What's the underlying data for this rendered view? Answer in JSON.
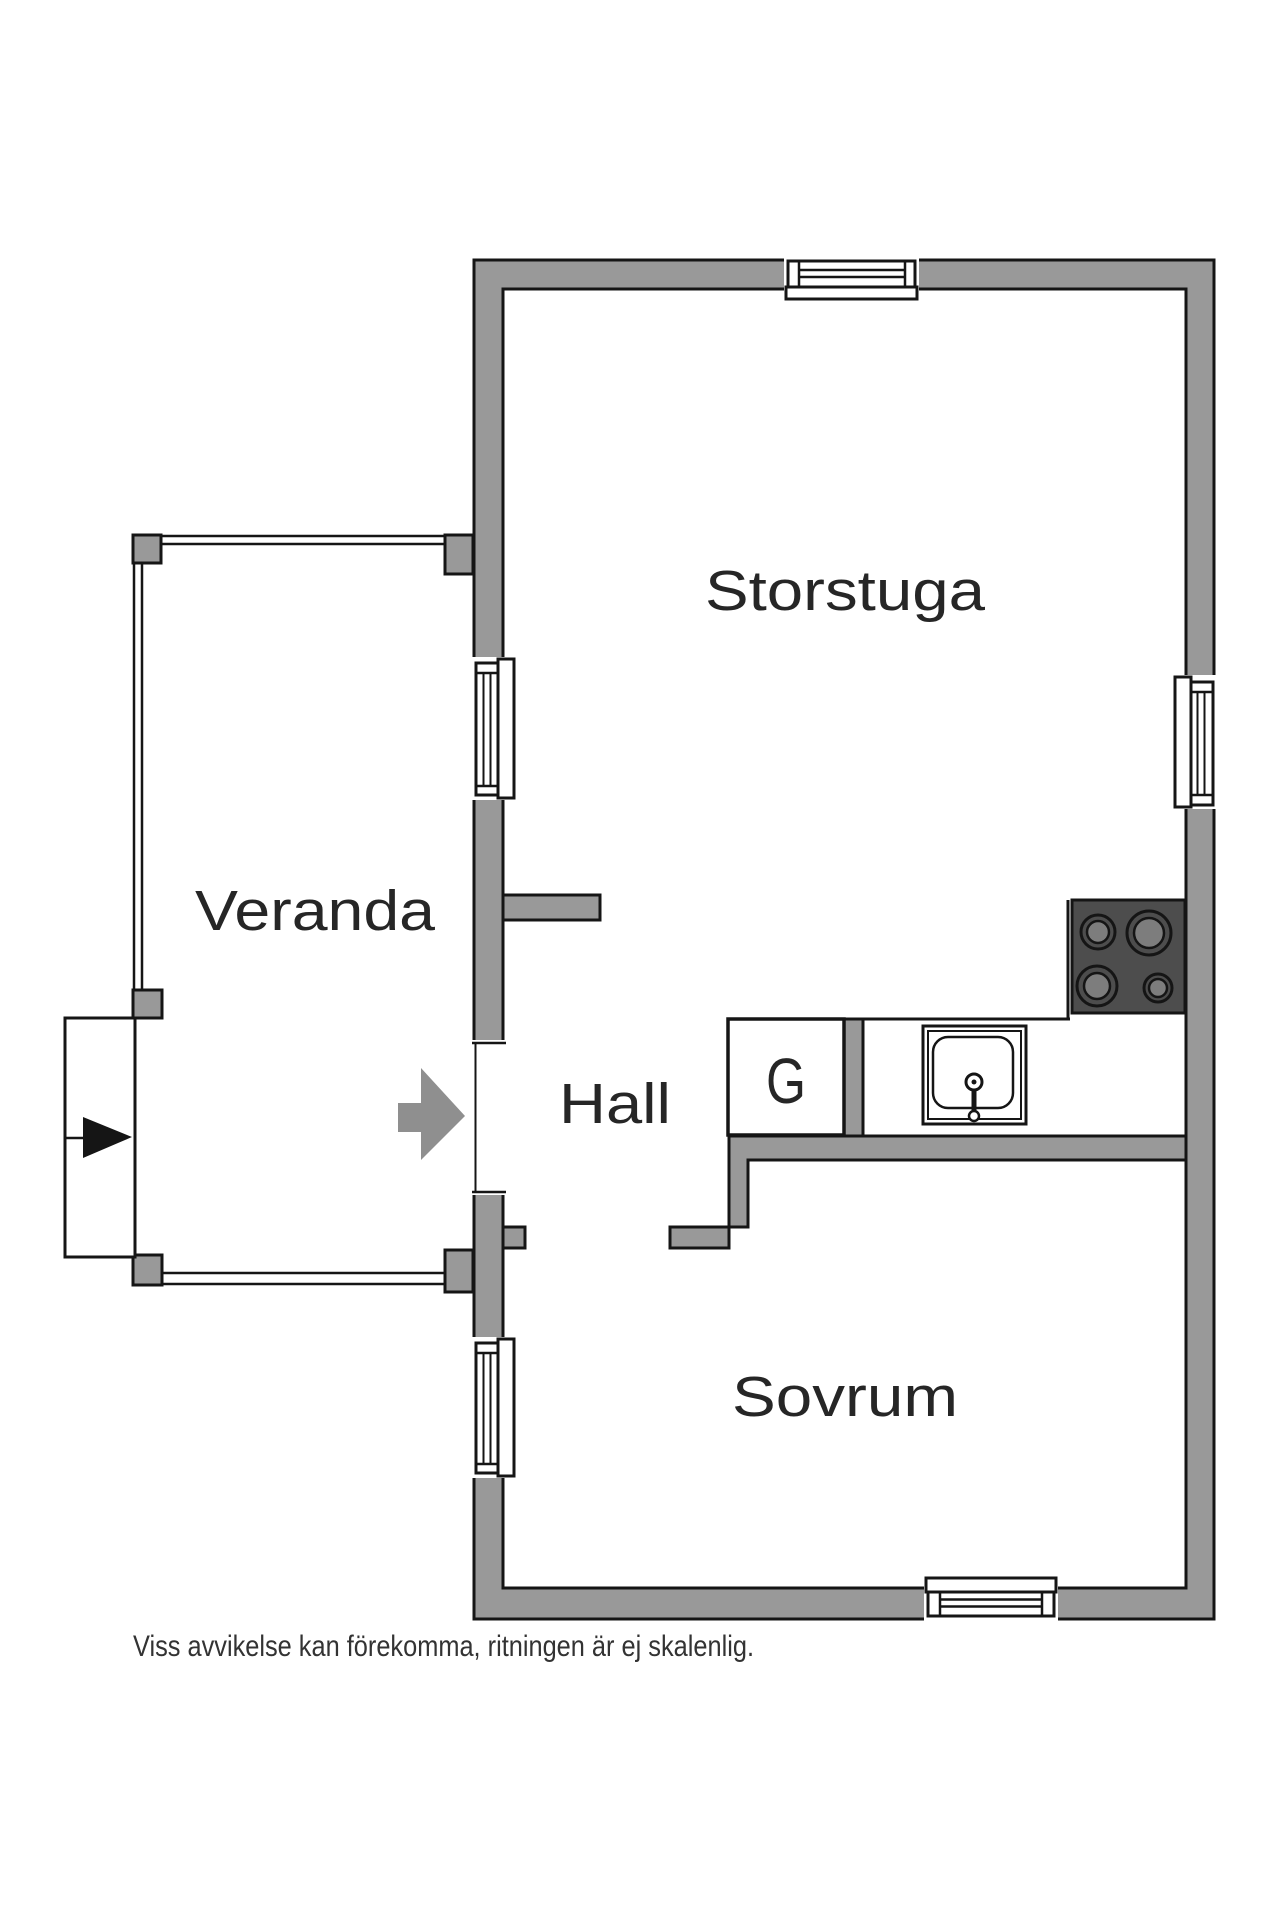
{
  "title": "Floor plan",
  "labels": {
    "storstuga": "Storstuga",
    "veranda": "Veranda",
    "hall": "Hall",
    "closet": "G",
    "sovrum": "Sovrum"
  },
  "disclaimer": "Viss avvikelse kan förekomma, ritningen är ej skalenlig.",
  "colors": {
    "wall": "#999999",
    "outline": "#151515",
    "stove_body": "#4d4d4d",
    "burner": "#7d7d7d",
    "entry_arrow": "#8f8f8f",
    "label_text": "#262626",
    "background": "#ffffff"
  },
  "fixtures": {
    "stove_burner_count": 4,
    "window_count": 5,
    "entrance_marker": "step-arrow"
  }
}
